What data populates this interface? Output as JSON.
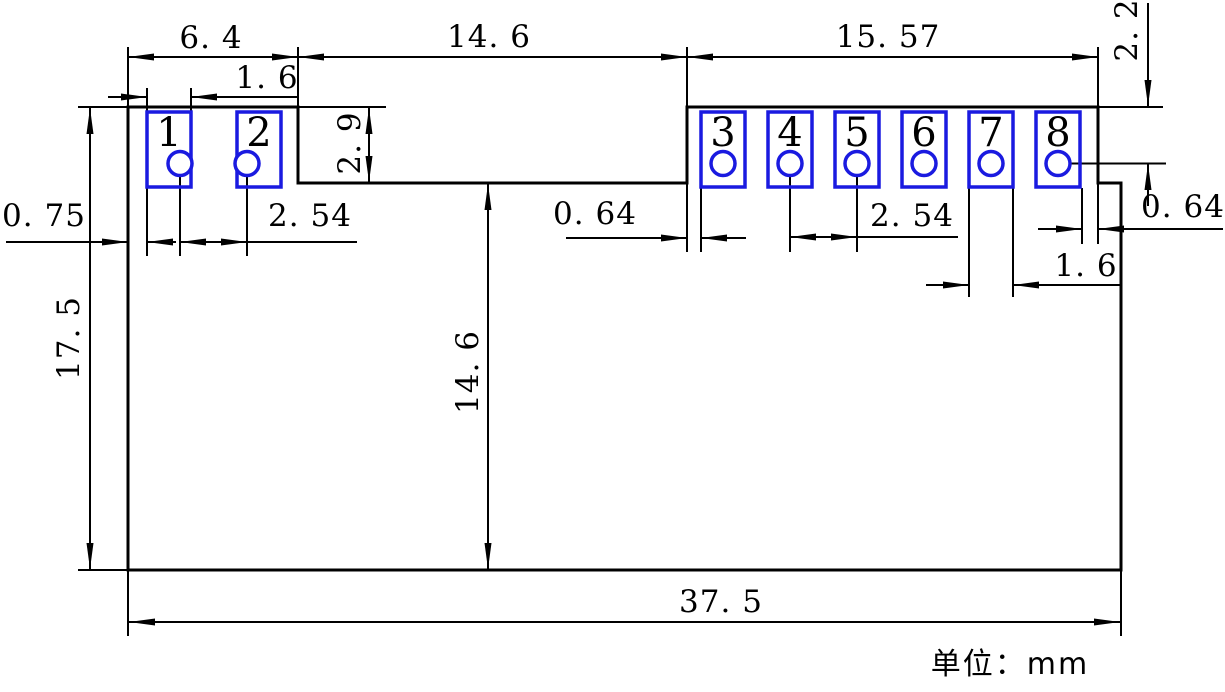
{
  "drawing": {
    "title": "2x4-pad module footprint dimension drawing",
    "unit_note": "单位：mm",
    "dimensions": {
      "top_left_width": "6. 4",
      "top_middle_width": "14. 6",
      "top_right_width": "15. 57",
      "pad1_width": "1. 6",
      "top_to_pin8_center": "2. 2",
      "notch_depth": "2. 9",
      "left_edge_to_pad1": "0. 75",
      "pad_pitch_left": "2. 54",
      "edge_to_pad3": "0. 64",
      "pad_pitch_right": "2. 54",
      "pad8_to_edge": "0. 64",
      "pad7_width": "1. 6",
      "body_height": "17. 5",
      "notch_to_bottom": "14. 6",
      "total_width": "37. 5"
    },
    "pads": [
      {
        "number": "1",
        "rect_x": 147,
        "hole_cx": 180
      },
      {
        "number": "2",
        "rect_x": 237,
        "hole_cx": 247
      },
      {
        "number": "3",
        "rect_x": 701,
        "hole_cx": 723
      },
      {
        "number": "4",
        "rect_x": 768,
        "hole_cx": 790
      },
      {
        "number": "5",
        "rect_x": 835,
        "hole_cx": 857
      },
      {
        "number": "6",
        "rect_x": 902,
        "hole_cx": 924
      },
      {
        "number": "7",
        "rect_x": 969,
        "hole_cx": 991
      },
      {
        "number": "8",
        "rect_x": 1036,
        "hole_cx": 1058
      }
    ],
    "pad_geometry": {
      "rect_y": 112,
      "rect_w": 44,
      "rect_h": 75,
      "hole_cy": 163.5,
      "hole_r": 12
    },
    "colors": {
      "outline": "#000000",
      "pad": "#1a1ae0",
      "pad_number": "#c03030"
    }
  }
}
